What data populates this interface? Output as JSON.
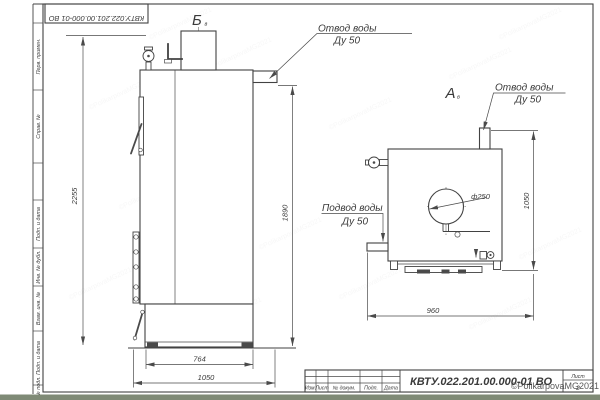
{
  "sheet": {
    "watermark": "©PolikarpovaMG2021",
    "bottom_bar_color": "#7f8a76",
    "line_color": "#424242",
    "watermark_color": "#9aa0a0"
  },
  "margin": {
    "doc_number_rotated": "КВТУ.022.201.00.000-01 ВО",
    "cells": [
      "Перв. примен.",
      "Справ. №",
      "Подп. и дата",
      "Инв. № дубл.",
      "Взам. инв. №",
      "Подп. и дата",
      "Инв. № подл."
    ]
  },
  "view_b": {
    "label": "Б",
    "label_sub": "в",
    "callout_outlet_line1": "Отвод воды",
    "callout_outlet_line2": "Ду 50",
    "dim_total_height": "2255",
    "dim_body_height": "1890",
    "dim_base_width": "764",
    "dim_total_width": "1050"
  },
  "view_a": {
    "label": "А",
    "label_sub": "в",
    "callout_outlet_line1": "Отвод воды",
    "callout_outlet_line2": "Ду 50",
    "callout_inlet_line1": "Подвод воды",
    "callout_inlet_line2": "Ду 50",
    "dim_height": "1050",
    "dim_width": "960",
    "dim_diameter": "ф250"
  },
  "title_block": {
    "designation": "КВТУ.022.201.00.000-01 ВО",
    "col_izm": "Изм.",
    "col_list": "Лист",
    "col_doc": "№ докум.",
    "col_podp": "Подп.",
    "col_data": "Дата",
    "sheet_label": "Лист",
    "sheet_number": "2"
  }
}
